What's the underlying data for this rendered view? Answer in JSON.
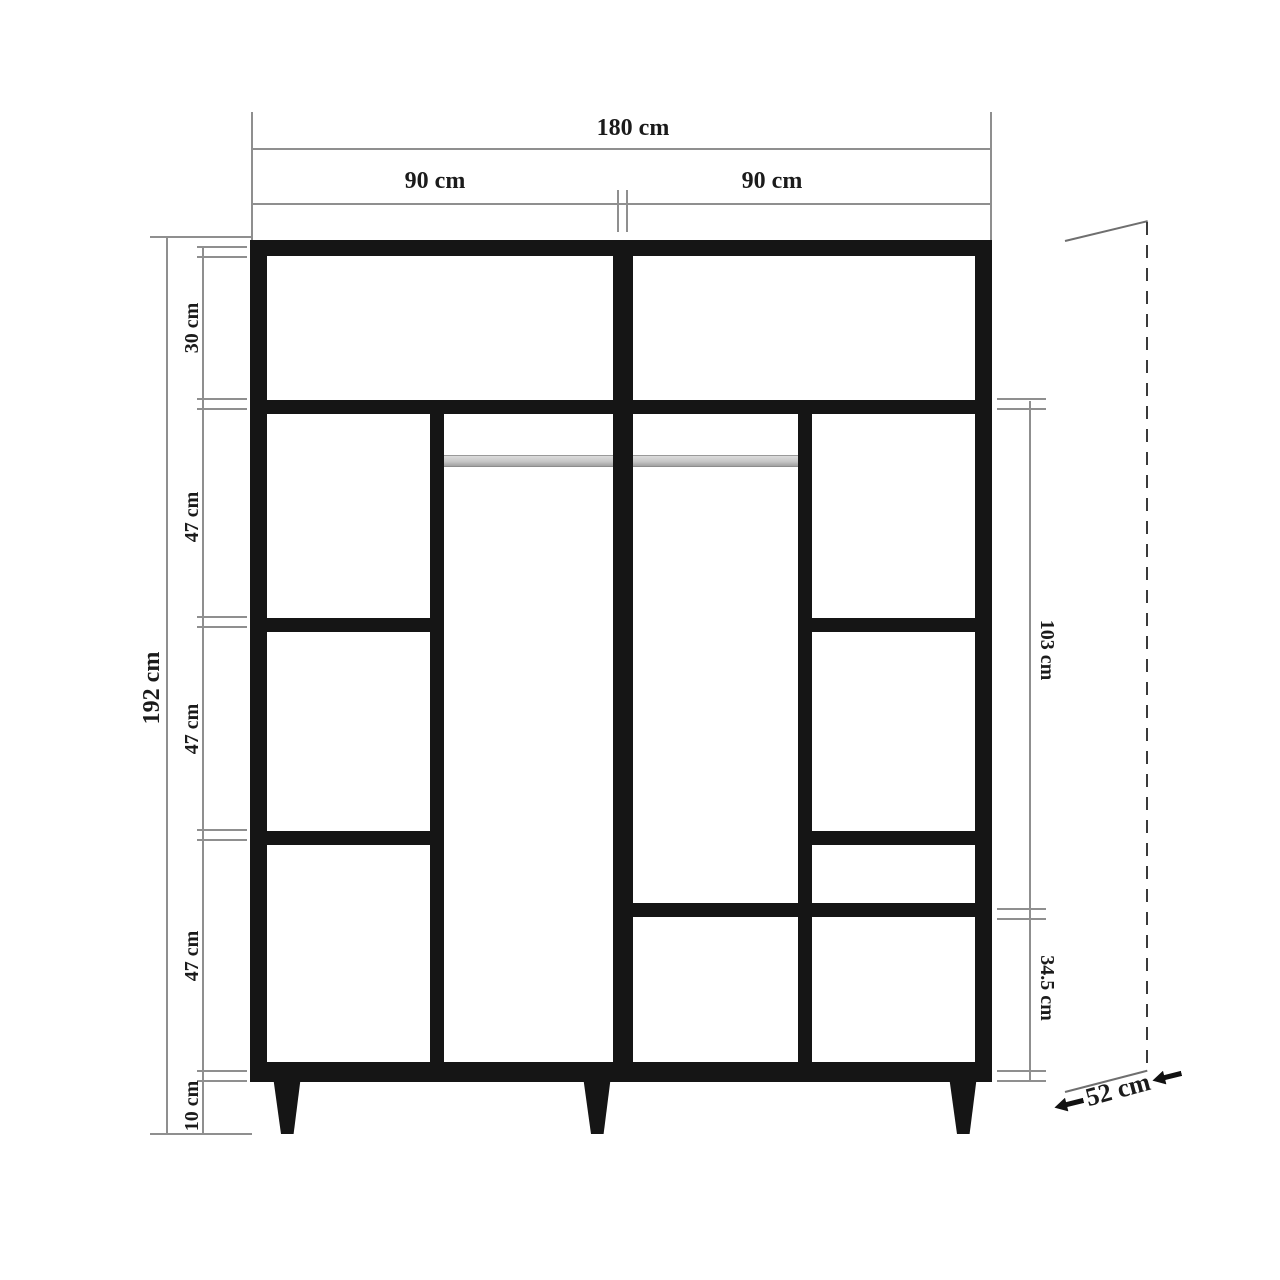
{
  "diagram": {
    "subject": "wardrobe-dimension-drawing",
    "view": "front elevation with depth indicator"
  },
  "dims": {
    "total_width": "180 cm",
    "left_width": "90 cm",
    "right_width": "90 cm",
    "total_height": "192 cm",
    "left_sections": [
      "30 cm",
      "47 cm",
      "47 cm",
      "47 cm",
      "10 cm"
    ],
    "right_upper": "103 cm",
    "right_lower": "34.5 cm",
    "depth": "52 cm"
  },
  "colors": {
    "cabinet_line": "#151515",
    "dimension_line": "#8f8f8f",
    "label_text": "#1b1b1b",
    "hanger_rod": "#c7c7c7",
    "dashed_depth_line": "#3a3a3a"
  }
}
